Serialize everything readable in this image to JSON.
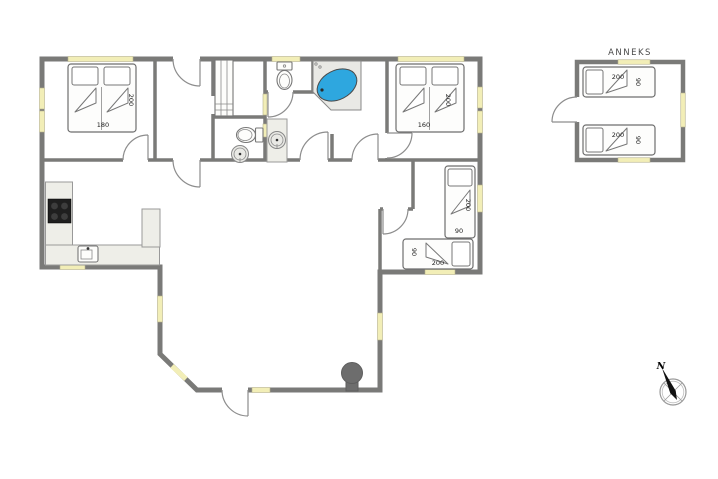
{
  "plan": {
    "region_label": "ANNEKS",
    "compass_label": "N"
  },
  "colors": {
    "wall": "#7a7a78",
    "window": "#f2eeb7",
    "water": "#2ea7df",
    "counter": "#eeeee8",
    "cooktop": "#1f1f1f",
    "stove": "#6d6d6d",
    "fixture": "#e9e9e5"
  },
  "dimensions": {
    "double_bed_left": {
      "w": "180",
      "l": "200"
    },
    "double_bed_right": {
      "w": "160",
      "l": "200"
    },
    "single_bed_vertical": {
      "w": "90",
      "l": "200"
    },
    "single_bed_horizontal": {
      "w": "90",
      "l": "200"
    },
    "anneks_bed_top": {
      "w": "90",
      "l": "200"
    },
    "anneks_bed_bottom": {
      "w": "90",
      "l": "200"
    }
  }
}
